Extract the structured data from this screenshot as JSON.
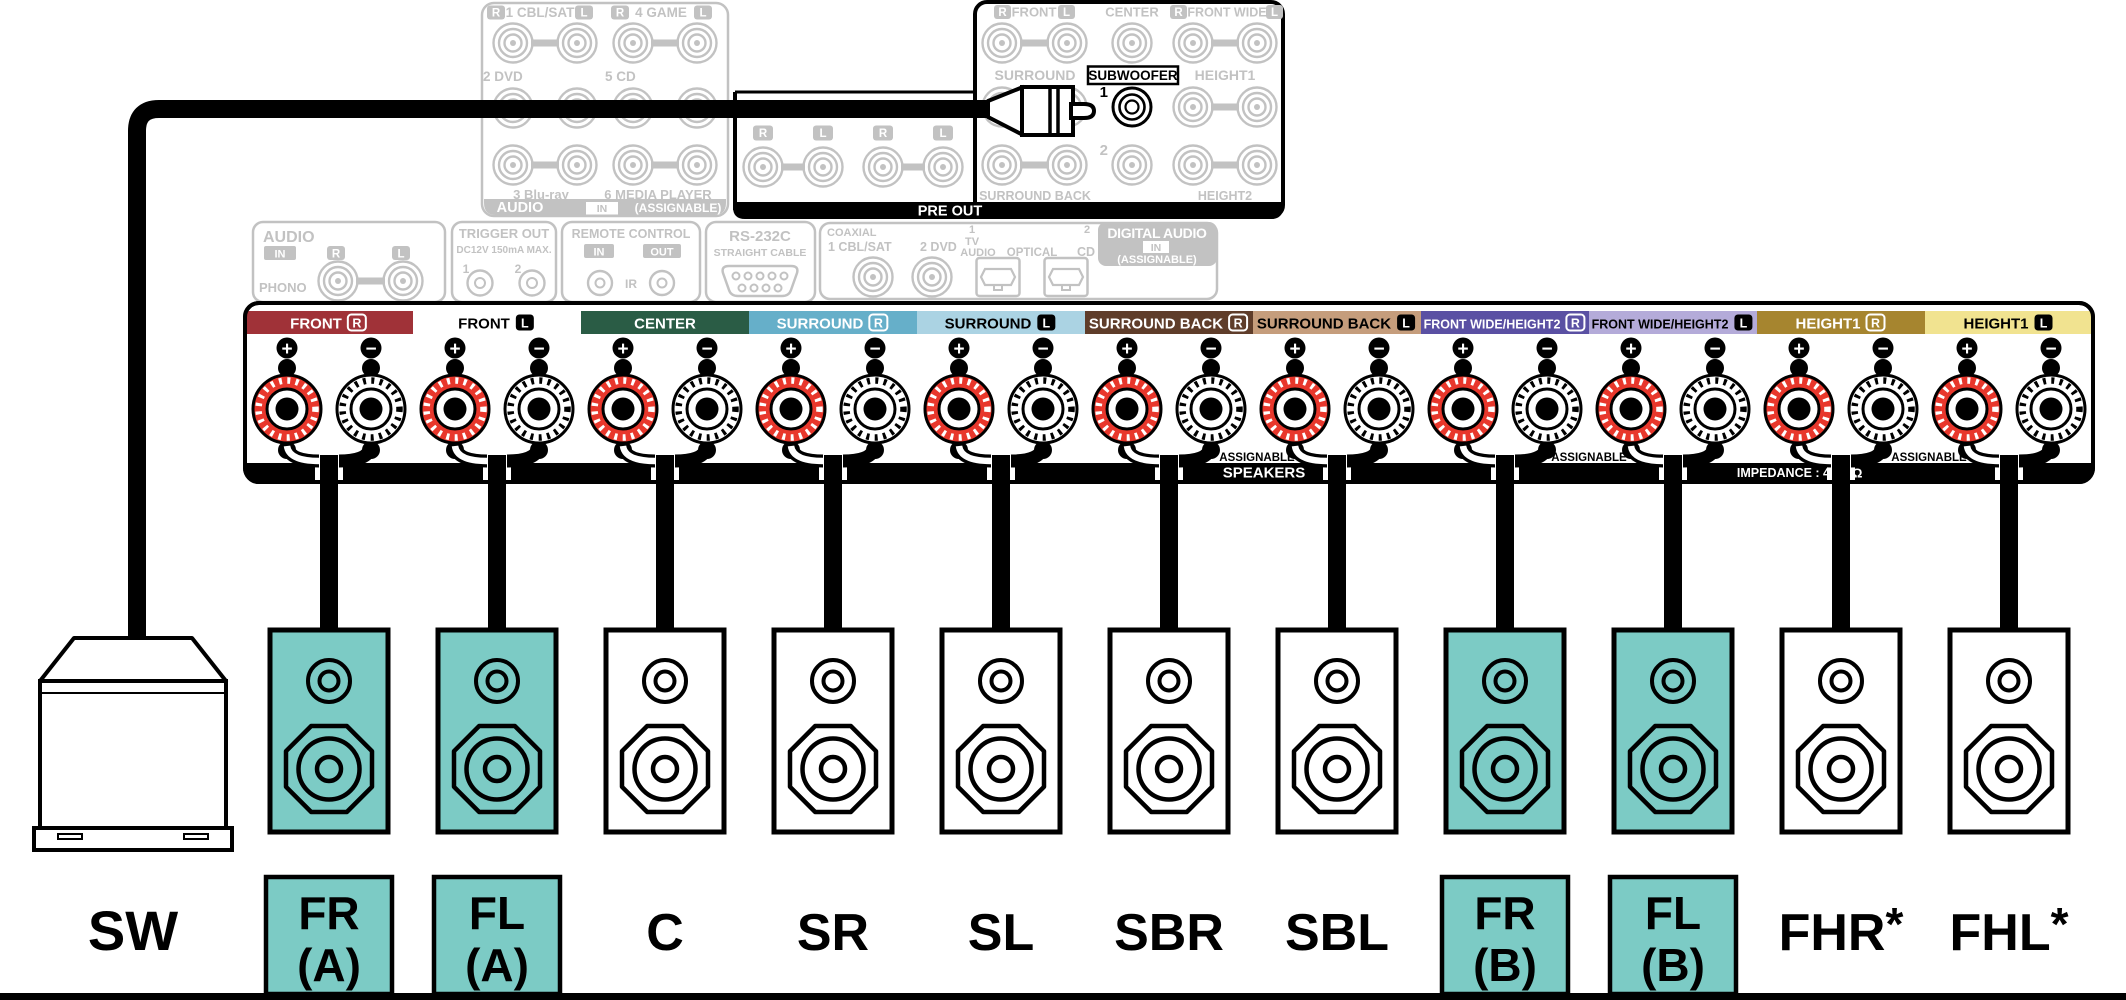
{
  "colors": {
    "gray": "#c2c2c2",
    "teal": "#7ccbc5",
    "post_red": "#e8372c",
    "black": "#000000"
  },
  "rear_panel": {
    "audio_in_box": {
      "row1": [
        {
          "r": "R",
          "label": "1 CBL/SAT",
          "l": "L"
        },
        {
          "r": "R",
          "label": "4 GAME",
          "l": "L"
        }
      ],
      "row2": [
        "2 DVD",
        "5 CD"
      ],
      "row3": [
        "3 Blu-ray",
        "6 MEDIA PLAYER"
      ],
      "footer": {
        "title": "AUDIO",
        "in_badge": "IN",
        "note": "(ASSIGNABLE)"
      }
    },
    "io_boxes": {
      "phono": {
        "title": "AUDIO",
        "in_badge": "IN",
        "r_badge": "R",
        "l_badge": "L",
        "label": "PHONO"
      },
      "trigger": {
        "title": "TRIGGER OUT",
        "subtitle": "DC12V 150mA MAX.",
        "num1": "1",
        "num2": "2"
      },
      "remote": {
        "title": "REMOTE CONTROL",
        "in_badge": "IN",
        "out_badge": "OUT",
        "ir": "IR"
      },
      "rs232c": {
        "title": "RS-232C",
        "subtitle": "STRAIGHT CABLE"
      },
      "digital": {
        "coaxial_label": "COAXIAL",
        "coax1": "1 CBL/SAT",
        "coax2": "2 DVD",
        "opt1_num": "1",
        "opt1_line1": "TV",
        "opt1_line2": "AUDIO",
        "optical_label": "OPTICAL",
        "opt2_num": "2",
        "opt2_label": "CD",
        "title": "DIGITAL AUDIO",
        "in_badge": "IN",
        "note": "(ASSIGNABLE)"
      }
    },
    "pre_out": {
      "bar_label": "PRE OUT",
      "front_r": "R",
      "front": "FRONT",
      "front_l": "L",
      "center": "CENTER",
      "front_wide_r": "R",
      "front_wide": "FRONT WIDE",
      "front_wide_l": "L",
      "surround": "SURROUND",
      "subwoofer": "SUBWOOFER",
      "height1": "HEIGHT1",
      "num1": "1",
      "num2": "2",
      "surround_back": "SURROUND BACK",
      "height2": "HEIGHT2",
      "ext_badges": [
        "R",
        "L",
        "R",
        "L"
      ]
    }
  },
  "speaker_terminals": {
    "plus": "+",
    "minus": "−",
    "assignable": "ASSIGNABLE",
    "speakers_label": "SPEAKERS",
    "impedance_prefix": "IMPEDANCE : 4",
    "impedance_suffix": "Ω",
    "channels": [
      {
        "label": "FRONT",
        "badge": "R",
        "band": "#a03238",
        "text": "#ffffff",
        "badge_style": "outline"
      },
      {
        "label": "FRONT",
        "badge": "L",
        "band": "#ffffff",
        "text": "#000000",
        "badge_style": "filled"
      },
      {
        "label": "CENTER",
        "badge": "",
        "band": "#2a5c45",
        "text": "#ffffff",
        "badge_style": "none"
      },
      {
        "label": "SURROUND",
        "badge": "R",
        "band": "#66afc9",
        "text": "#ffffff",
        "badge_style": "outline"
      },
      {
        "label": "SURROUND",
        "badge": "L",
        "band": "#abd3e3",
        "text": "#000000",
        "badge_style": "filled"
      },
      {
        "label": "SURROUND BACK",
        "badge": "R",
        "band": "#5f3d2a",
        "text": "#ffffff",
        "badge_style": "outline"
      },
      {
        "label": "SURROUND BACK",
        "badge": "L",
        "band": "#c59d7c",
        "text": "#000000",
        "badge_style": "filled"
      },
      {
        "label": "FRONT WIDE/HEIGHT2",
        "badge": "R",
        "band": "#5a50a3",
        "text": "#ffffff",
        "badge_style": "outline",
        "small": true
      },
      {
        "label": "FRONT WIDE/HEIGHT2",
        "badge": "L",
        "band": "#b4abd9",
        "text": "#000000",
        "badge_style": "filled",
        "small": true
      },
      {
        "label": "HEIGHT1",
        "badge": "R",
        "band": "#a6852f",
        "text": "#ffffff",
        "badge_style": "outline"
      },
      {
        "label": "HEIGHT1",
        "badge": "L",
        "band": "#f1e390",
        "text": "#000000",
        "badge_style": "filled"
      }
    ]
  },
  "bottom_row": {
    "subwoofer": "SW",
    "speakers": [
      {
        "lines": [
          "FR",
          "(A)"
        ],
        "boxed": true
      },
      {
        "lines": [
          "FL",
          "(A)"
        ],
        "boxed": true
      },
      {
        "lines": [
          "C"
        ]
      },
      {
        "lines": [
          "SR"
        ]
      },
      {
        "lines": [
          "SL"
        ]
      },
      {
        "lines": [
          "SBR"
        ]
      },
      {
        "lines": [
          "SBL"
        ]
      },
      {
        "lines": [
          "FR",
          "(B)"
        ],
        "boxed": true
      },
      {
        "lines": [
          "FL",
          "(B)"
        ],
        "boxed": true
      },
      {
        "lines": [
          "FHR"
        ],
        "asterisk": "*"
      },
      {
        "lines": [
          "FHL"
        ],
        "asterisk": "*"
      }
    ]
  }
}
